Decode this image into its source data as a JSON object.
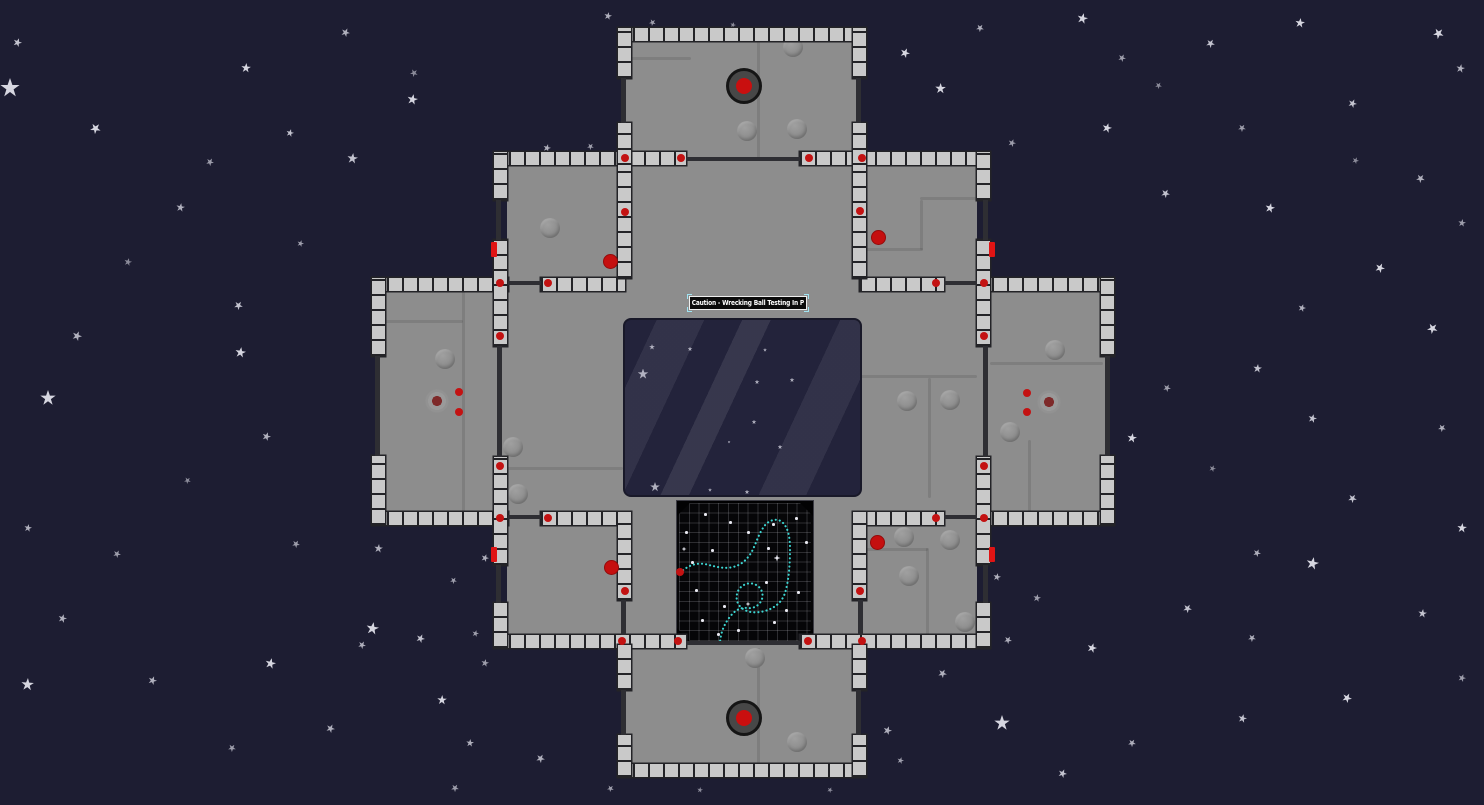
{
  "scene": {
    "width": 1484,
    "height": 805,
    "colors": {
      "space_background": "#1d1d32",
      "star": "#d6d6e0",
      "floor": "#8d8d8d",
      "wall_tile": "#c9c9c9",
      "wall_gap": "#232327",
      "interior_wall": "#2e2e33",
      "alert_red": "#c31212",
      "door_red": "#e01414",
      "window_glass": "#23233b",
      "grid_background": "#060608",
      "trajectory_cyan": "#3cd6d2",
      "sign_background": "#0b0b0b",
      "sign_border": "#efefef",
      "selection_handle": "#9fe3f2"
    },
    "sign": {
      "label": "Caution - Wrecking Ball Testing In P",
      "x": 689,
      "y": 296,
      "w": 118,
      "h": 14
    },
    "window": {
      "x": 623,
      "y": 318,
      "w": 239,
      "h": 179,
      "stars": [
        [
          27,
          27,
          6
        ],
        [
          65,
          29,
          5
        ],
        [
          18,
          54,
          11
        ],
        [
          132,
          62,
          5
        ],
        [
          167,
          60,
          5
        ],
        [
          129,
          102,
          5
        ],
        [
          155,
          127,
          5
        ],
        [
          30,
          167,
          10
        ],
        [
          85,
          170,
          4
        ],
        [
          122,
          172,
          5
        ],
        [
          104,
          122,
          3
        ],
        [
          140,
          30,
          4
        ]
      ]
    },
    "grid": {
      "x": 676,
      "y": 500,
      "w": 138,
      "h": 144,
      "trajectory_path": "M 3 72 C 12 63 22 61 32 64 C 40 66 48 68 56 66 C 64 64 68 60 72 55 C 78 47 80 36 86 27 C 90 20 99 16 105 21 C 111 26 113 36 113 48 C 113 62 112 79 108 92 C 105 101 98 107 88 110 C 80 112 72 112 66 108 C 60 104 58 97 61 90 C 64 84 71 81 77 83 C 83 85 87 91 85 98 C 83 104 77 108 70 107 C 63 106 57 110 52 117 C 47 124 44 131 43 141",
      "start_dot": [
        3,
        71
      ],
      "dots": [
        [
          27,
          12
        ],
        [
          95,
          22
        ],
        [
          14,
          60
        ],
        [
          34,
          48
        ],
        [
          88,
          80
        ],
        [
          18,
          88
        ],
        [
          46,
          104
        ],
        [
          96,
          120
        ],
        [
          60,
          128
        ],
        [
          24,
          118
        ],
        [
          108,
          108
        ],
        [
          70,
          30
        ],
        [
          120,
          90
        ],
        [
          8,
          30
        ],
        [
          128,
          40
        ],
        [
          52,
          20
        ],
        [
          118,
          16
        ],
        [
          40,
          132
        ],
        [
          90,
          46
        ]
      ],
      "sparkles": [
        [
          100,
          57,
          7
        ],
        [
          71,
          103,
          5
        ],
        [
          7,
          48,
          5
        ]
      ]
    },
    "hatches": [
      [
        744,
        86
      ],
      [
        744,
        718
      ]
    ],
    "floors": [
      [
        624,
        34,
        234,
        128
      ],
      [
        507,
        158,
        470,
        483
      ],
      [
        378,
        284,
        135,
        234
      ],
      [
        971,
        284,
        137,
        234
      ],
      [
        624,
        643,
        234,
        128
      ]
    ],
    "seams": [
      [
        757,
        41,
        3,
        119
      ],
      [
        631,
        57,
        60,
        3
      ],
      [
        855,
        248,
        68,
        3
      ],
      [
        920,
        200,
        3,
        50
      ],
      [
        920,
        197,
        66,
        3
      ],
      [
        507,
        467,
        116,
        3
      ],
      [
        860,
        375,
        117,
        3
      ],
      [
        928,
        378,
        3,
        120
      ],
      [
        385,
        320,
        78,
        3
      ],
      [
        462,
        291,
        3,
        230
      ],
      [
        990,
        362,
        113,
        3
      ],
      [
        1028,
        440,
        3,
        80
      ],
      [
        757,
        648,
        3,
        116
      ],
      [
        860,
        548,
        68,
        3
      ],
      [
        926,
        548,
        3,
        90
      ]
    ],
    "bumps": [
      [
        550,
        228
      ],
      [
        747,
        131
      ],
      [
        797,
        129
      ],
      [
        793,
        47
      ],
      [
        445,
        359
      ],
      [
        513,
        447
      ],
      [
        518,
        494
      ],
      [
        755,
        658
      ],
      [
        797,
        742
      ],
      [
        904,
        537
      ],
      [
        950,
        540
      ],
      [
        909,
        576
      ],
      [
        965,
        622
      ],
      [
        907,
        401
      ],
      [
        950,
        400
      ],
      [
        1055,
        350
      ],
      [
        1010,
        432
      ]
    ],
    "walls_h": [
      [
        618,
        28,
        248,
        13
      ],
      [
        494,
        152,
        192,
        13
      ],
      [
        800,
        152,
        190,
        13
      ],
      [
        372,
        278,
        136,
        13
      ],
      [
        541,
        278,
        84,
        13
      ],
      [
        860,
        278,
        84,
        13
      ],
      [
        977,
        278,
        137,
        13
      ],
      [
        372,
        512,
        136,
        13
      ],
      [
        541,
        512,
        84,
        13
      ],
      [
        860,
        512,
        84,
        13
      ],
      [
        977,
        512,
        137,
        13
      ],
      [
        494,
        635,
        192,
        13
      ],
      [
        800,
        635,
        190,
        13
      ],
      [
        618,
        764,
        248,
        13
      ]
    ],
    "walls_v": [
      [
        618,
        28,
        13,
        50
      ],
      [
        618,
        123,
        13,
        42
      ],
      [
        853,
        28,
        13,
        50
      ],
      [
        853,
        123,
        13,
        42
      ],
      [
        618,
        165,
        13,
        113
      ],
      [
        853,
        165,
        13,
        113
      ],
      [
        494,
        152,
        13,
        48
      ],
      [
        494,
        240,
        13,
        106
      ],
      [
        494,
        457,
        13,
        108
      ],
      [
        494,
        603,
        13,
        45
      ],
      [
        977,
        152,
        13,
        48
      ],
      [
        977,
        240,
        13,
        106
      ],
      [
        977,
        457,
        13,
        108
      ],
      [
        977,
        603,
        13,
        45
      ],
      [
        372,
        278,
        13,
        78
      ],
      [
        372,
        456,
        13,
        69
      ],
      [
        1101,
        278,
        13,
        78
      ],
      [
        1101,
        456,
        13,
        69
      ],
      [
        618,
        512,
        13,
        88
      ],
      [
        853,
        512,
        13,
        88
      ],
      [
        618,
        645,
        13,
        45
      ],
      [
        618,
        735,
        13,
        42
      ],
      [
        853,
        645,
        13,
        45
      ],
      [
        853,
        735,
        13,
        42
      ]
    ],
    "thin_walls": [
      [
        686,
        157,
        114,
        4
      ],
      [
        621,
        78,
        5,
        45
      ],
      [
        856,
        78,
        5,
        45
      ],
      [
        496,
        200,
        5,
        40
      ],
      [
        983,
        200,
        5,
        40
      ],
      [
        508,
        281,
        33,
        4
      ],
      [
        944,
        281,
        33,
        4
      ],
      [
        497,
        346,
        5,
        111
      ],
      [
        983,
        346,
        5,
        111
      ],
      [
        375,
        356,
        5,
        100
      ],
      [
        1105,
        356,
        5,
        100
      ],
      [
        508,
        515,
        33,
        4
      ],
      [
        944,
        515,
        33,
        4
      ],
      [
        496,
        565,
        5,
        38
      ],
      [
        983,
        565,
        5,
        38
      ],
      [
        621,
        600,
        5,
        35
      ],
      [
        858,
        600,
        5,
        35
      ],
      [
        686,
        641,
        114,
        4
      ],
      [
        621,
        690,
        5,
        45
      ],
      [
        856,
        690,
        5,
        45
      ]
    ],
    "door_markers": [
      [
        491,
        242
      ],
      [
        989,
        242
      ],
      [
        491,
        547
      ],
      [
        989,
        547
      ]
    ],
    "sensor_dots": [
      [
        625,
        158
      ],
      [
        681,
        158
      ],
      [
        809,
        158
      ],
      [
        862,
        158
      ],
      [
        625,
        212
      ],
      [
        860,
        211
      ],
      [
        500,
        283
      ],
      [
        548,
        283
      ],
      [
        936,
        283
      ],
      [
        984,
        283
      ],
      [
        500,
        336
      ],
      [
        984,
        336
      ],
      [
        500,
        466
      ],
      [
        984,
        466
      ],
      [
        500,
        518
      ],
      [
        548,
        518
      ],
      [
        936,
        518
      ],
      [
        984,
        518
      ],
      [
        625,
        591
      ],
      [
        860,
        591
      ],
      [
        622,
        641
      ],
      [
        678,
        641
      ],
      [
        808,
        641
      ],
      [
        862,
        641
      ],
      [
        459,
        392
      ],
      [
        459,
        412
      ],
      [
        1027,
        393
      ],
      [
        1027,
        412
      ]
    ],
    "guards": [
      [
        610,
        261
      ],
      [
        878,
        237
      ],
      [
        611,
        567
      ],
      [
        877,
        542
      ]
    ],
    "splats": [
      [
        437,
        401
      ],
      [
        1049,
        402
      ]
    ],
    "stars": [
      [
        10,
        88,
        20,
        1,
        0
      ],
      [
        17,
        42,
        9,
        0.9,
        20
      ],
      [
        95,
        128,
        11,
        1,
        40
      ],
      [
        180,
        207,
        9,
        0.8,
        10
      ],
      [
        210,
        162,
        8,
        0.7,
        30
      ],
      [
        290,
        133,
        8,
        0.9,
        15
      ],
      [
        246,
        68,
        10,
        1,
        5
      ],
      [
        345,
        32,
        9,
        0.8,
        25
      ],
      [
        412,
        99,
        11,
        1,
        12
      ],
      [
        414,
        73,
        8,
        0.6,
        45
      ],
      [
        352,
        158,
        11,
        0.9,
        8
      ],
      [
        300,
        243,
        7,
        0.7,
        18
      ],
      [
        238,
        305,
        9,
        0.9,
        33
      ],
      [
        240,
        352,
        11,
        1,
        9
      ],
      [
        48,
        398,
        16,
        1,
        0
      ],
      [
        77,
        336,
        10,
        0.8,
        22
      ],
      [
        128,
        262,
        8,
        0.6,
        14
      ],
      [
        28,
        528,
        8,
        0.8,
        11
      ],
      [
        117,
        554,
        8,
        0.7,
        28
      ],
      [
        187,
        480,
        7,
        0.6,
        40
      ],
      [
        62,
        618,
        9,
        0.8,
        16
      ],
      [
        27,
        684,
        13,
        1,
        4
      ],
      [
        152,
        680,
        9,
        0.8,
        21
      ],
      [
        232,
        748,
        8,
        0.7,
        36
      ],
      [
        270,
        663,
        11,
        1,
        13
      ],
      [
        330,
        728,
        9,
        0.8,
        26
      ],
      [
        296,
        544,
        8,
        0.7,
        31
      ],
      [
        378,
        548,
        9,
        0.8,
        7
      ],
      [
        266,
        436,
        9,
        0.8,
        19
      ],
      [
        420,
        638,
        9,
        0.9,
        24
      ],
      [
        442,
        700,
        10,
        1,
        3
      ],
      [
        540,
        758,
        9,
        0.8,
        29
      ],
      [
        455,
        788,
        8,
        0.7,
        34
      ],
      [
        610,
        788,
        7,
        0.7,
        41
      ],
      [
        470,
        743,
        8,
        0.8,
        6
      ],
      [
        608,
        16,
        8,
        0.8,
        12
      ],
      [
        652,
        22,
        7,
        0.7,
        44
      ],
      [
        733,
        25,
        6,
        0.6,
        17
      ],
      [
        905,
        53,
        10,
        1,
        23
      ],
      [
        940,
        88,
        11,
        1,
        2
      ],
      [
        980,
        28,
        8,
        0.8,
        37
      ],
      [
        1082,
        18,
        11,
        1,
        14
      ],
      [
        1122,
        58,
        8,
        0.7,
        27
      ],
      [
        1210,
        43,
        9,
        0.9,
        32
      ],
      [
        1300,
        23,
        10,
        1,
        8
      ],
      [
        1438,
        33,
        11,
        1,
        42
      ],
      [
        1460,
        68,
        9,
        0.8,
        11
      ],
      [
        1352,
        103,
        9,
        0.9,
        24
      ],
      [
        1242,
        128,
        8,
        0.7,
        35
      ],
      [
        1107,
        128,
        10,
        1,
        16
      ],
      [
        1012,
        143,
        8,
        0.7,
        21
      ],
      [
        920,
        158,
        13,
        1,
        5
      ],
      [
        1165,
        193,
        9,
        0.9,
        30
      ],
      [
        1270,
        208,
        10,
        1,
        13
      ],
      [
        1420,
        178,
        9,
        0.8,
        38
      ],
      [
        1462,
        223,
        8,
        0.7,
        9
      ],
      [
        1380,
        268,
        10,
        1,
        25
      ],
      [
        1302,
        308,
        8,
        0.8,
        18
      ],
      [
        1432,
        328,
        11,
        1,
        43
      ],
      [
        1257,
        368,
        9,
        0.9,
        7
      ],
      [
        1167,
        388,
        8,
        0.7,
        28
      ],
      [
        1312,
        418,
        9,
        0.9,
        15
      ],
      [
        1442,
        428,
        8,
        0.8,
        39
      ],
      [
        1132,
        438,
        10,
        1,
        10
      ],
      [
        1212,
        468,
        7,
        0.6,
        22
      ],
      [
        1352,
        498,
        9,
        0.9,
        33
      ],
      [
        1462,
        528,
        10,
        1,
        6
      ],
      [
        1257,
        553,
        8,
        0.8,
        26
      ],
      [
        1312,
        563,
        13,
        1,
        12
      ],
      [
        1187,
        608,
        9,
        0.9,
        31
      ],
      [
        1092,
        648,
        10,
        1,
        17
      ],
      [
        1252,
        638,
        8,
        0.8,
        36
      ],
      [
        1422,
        613,
        9,
        0.9,
        8
      ],
      [
        1462,
        678,
        8,
        0.7,
        20
      ],
      [
        1347,
        698,
        10,
        1,
        27
      ],
      [
        1242,
        718,
        9,
        0.9,
        14
      ],
      [
        1132,
        743,
        8,
        0.8,
        34
      ],
      [
        1002,
        723,
        16,
        1,
        0
      ],
      [
        1062,
        773,
        9,
        0.9,
        23
      ],
      [
        942,
        673,
        9,
        0.8,
        29
      ],
      [
        1037,
        598,
        8,
        0.7,
        11
      ],
      [
        1158,
        85,
        7,
        0.6,
        33
      ],
      [
        1355,
        160,
        7,
        0.6,
        24
      ],
      [
        900,
        760,
        7,
        0.7,
        16
      ],
      [
        830,
        790,
        6,
        0.6,
        28
      ],
      [
        700,
        790,
        6,
        0.6,
        9
      ],
      [
        547,
        148,
        8,
        0.8,
        15
      ],
      [
        590,
        146,
        7,
        0.7,
        38
      ],
      [
        887,
        730,
        9,
        0.8,
        19
      ],
      [
        997,
        577,
        8,
        0.8,
        13
      ],
      [
        1008,
        640,
        8,
        0.8,
        31
      ],
      [
        485,
        558,
        8,
        0.8,
        20
      ],
      [
        453,
        580,
        7,
        0.7,
        35
      ],
      [
        372,
        628,
        13,
        1,
        10
      ],
      [
        475,
        633,
        7,
        0.7,
        15
      ],
      [
        362,
        645,
        8,
        0.8,
        30
      ],
      [
        485,
        663,
        8,
        0.7,
        12
      ]
    ]
  }
}
